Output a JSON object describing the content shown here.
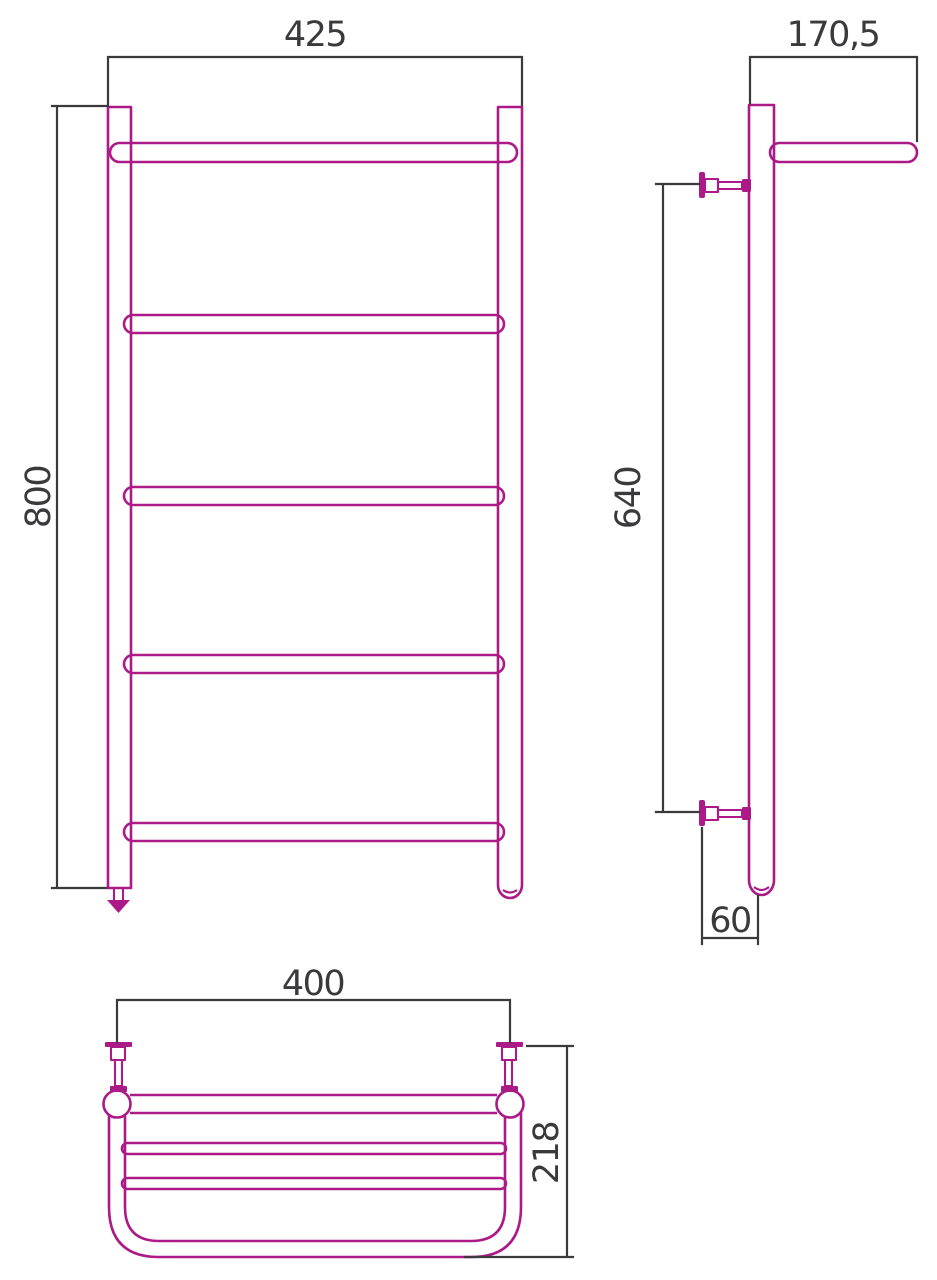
{
  "colors": {
    "product_outline": "#AB1A86",
    "dimension": "#3A3A3C",
    "background": "#FFFFFF"
  },
  "views": {
    "front": {
      "dims": {
        "width": "425",
        "height": "800"
      },
      "rung_count": 5
    },
    "side": {
      "dims": {
        "depth": "170,5",
        "bracket_span": "640",
        "wall_offset": "60"
      }
    },
    "top": {
      "dims": {
        "width": "400",
        "depth": "218"
      }
    }
  }
}
